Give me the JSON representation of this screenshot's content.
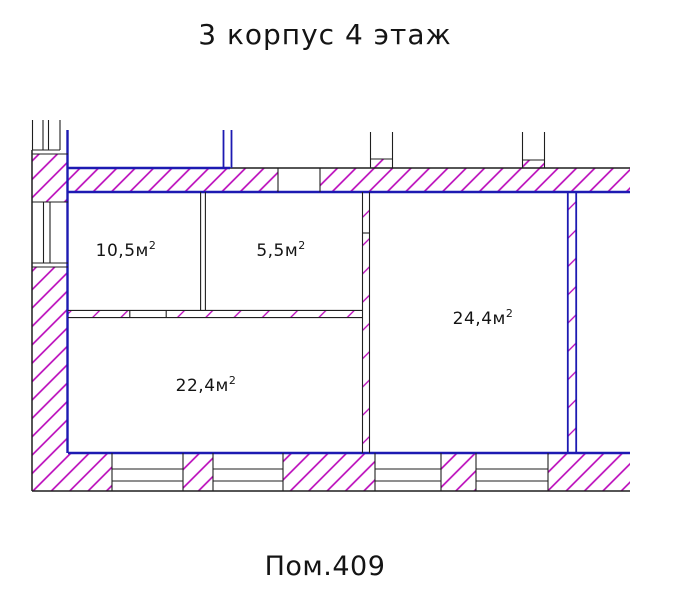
{
  "title": "3 корпус 4 этаж",
  "footer": "Пом.409",
  "rooms": [
    {
      "id": "room-10-5",
      "area": "10,5м",
      "sup": "2"
    },
    {
      "id": "room-5-5",
      "area": "5,5м",
      "sup": "2"
    },
    {
      "id": "room-24-4",
      "area": "24,4м",
      "sup": "2"
    },
    {
      "id": "room-22-4",
      "area": "22,4м",
      "sup": "2"
    }
  ],
  "colors": {
    "blue": "#1d1ab2",
    "hatch": "#b800b8",
    "outline": "#1f1f1f",
    "text": "#141414"
  }
}
